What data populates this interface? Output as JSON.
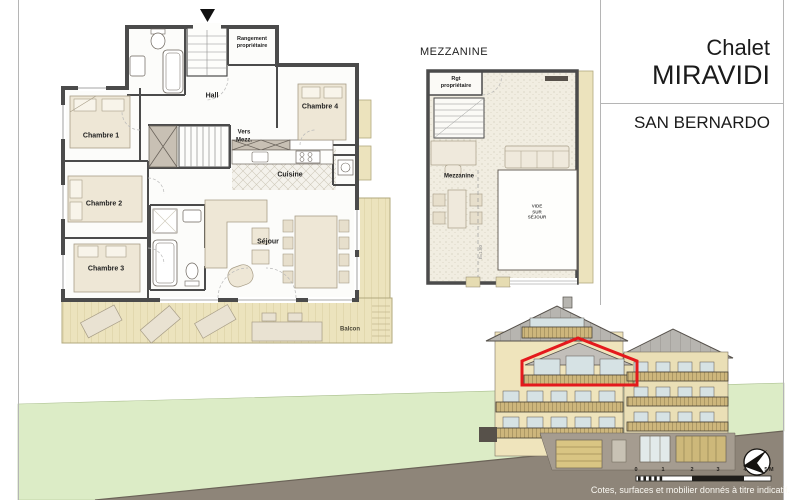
{
  "title_block": {
    "line1": "Chalet",
    "line2": "MIRAVIDI",
    "location": "SAN BERNARDO"
  },
  "main_plan": {
    "rooms": {
      "chambre1": "Chambre 1",
      "chambre2": "Chambre 2",
      "chambre3": "Chambre 3",
      "chambre4": "Chambre 4",
      "hall": "Hall",
      "vers_line1": "Vers",
      "vers_line2": "Mezz.",
      "cuisine": "Cuisine",
      "sejour": "Séjour",
      "balcon": "Balcon",
      "rangement_line1": "Rangement",
      "rangement_line2": "propriétaire"
    }
  },
  "mezzanine_plan": {
    "title": "MEZZANINE",
    "rooms": {
      "rgt_line1": "Rgt",
      "rgt_line2": "propriétaire",
      "mezzanine": "Mezzanine",
      "vide_line1": "VIDE",
      "vide_line2": "SUR",
      "vide_line3": "SÉJOUR",
      "height_note": "h=1.80"
    }
  },
  "footer": {
    "note": "Cotes, surfaces et mobilier donnés à titre indicatif.",
    "scale_labels": [
      "0",
      "1",
      "2",
      "3",
      "4",
      "5 M"
    ]
  },
  "colors": {
    "highlight_red": "#E4191C",
    "terrain_green": "#DCECC6",
    "terrain_ground": "#8E8579",
    "balcony_wood": "#ECE3BD",
    "facade_cream": "#EFE4BC",
    "wall_gray": "#4B4B4B"
  }
}
